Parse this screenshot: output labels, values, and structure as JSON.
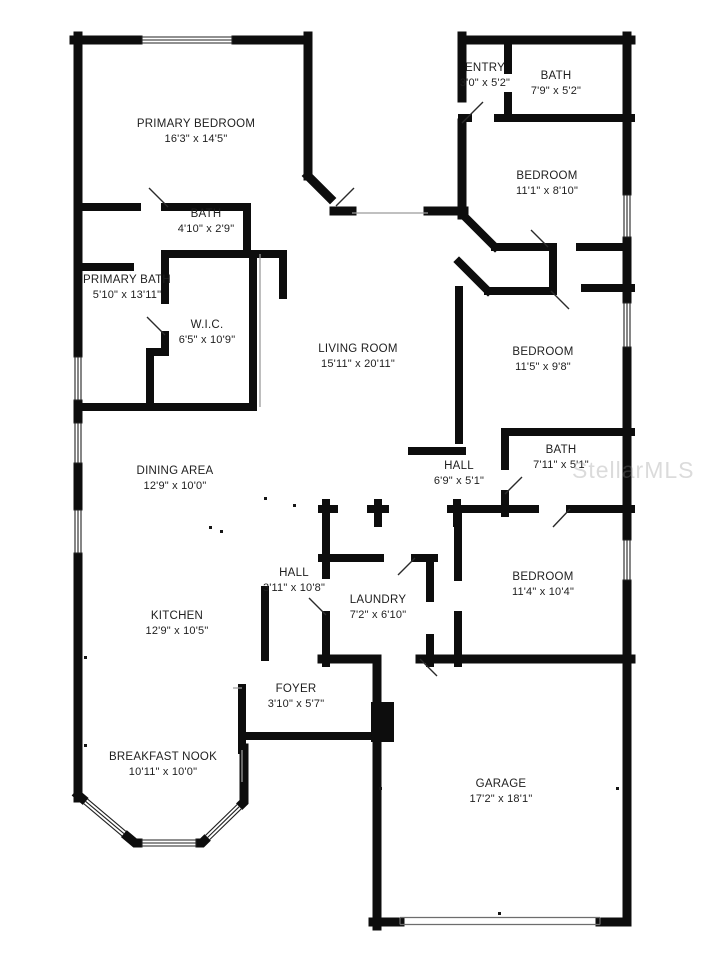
{
  "plan": {
    "type": "residential-floor-plan",
    "watermark": {
      "text": "StellarMLS",
      "color_hex": "#8a8a8a"
    },
    "colors": {
      "walls": "#0d0d0d",
      "labels": "#1e1e1e",
      "background": "#ffffff"
    },
    "rooms": [
      {
        "name": "PRIMARY BEDROOM",
        "dims": "16'3\" x 14'5\"",
        "cx": 196,
        "cy": 132
      },
      {
        "name": "BATH",
        "dims": "4'10\" x 2'9\"",
        "cx": 206,
        "cy": 222
      },
      {
        "name": "PRIMARY BATH",
        "dims": "5'10\" x 13'11\"",
        "cx": 127,
        "cy": 288
      },
      {
        "name": "W.I.C.",
        "dims": "6'5\" x 10'9\"",
        "cx": 207,
        "cy": 333
      },
      {
        "name": "LIVING ROOM",
        "dims": "15'11\" x 20'11\"",
        "cx": 358,
        "cy": 357
      },
      {
        "name": "ENTRY",
        "dims": "3'0\" x 5'2\"",
        "cx": 485,
        "cy": 76
      },
      {
        "name": "BATH",
        "dims": "7'9\" x 5'2\"",
        "cx": 556,
        "cy": 84
      },
      {
        "name": "BEDROOM",
        "dims": "11'1\" x 8'10\"",
        "cx": 547,
        "cy": 184
      },
      {
        "name": "BEDROOM",
        "dims": "11'5\" x 9'8\"",
        "cx": 543,
        "cy": 360
      },
      {
        "name": "BATH",
        "dims": "7'11\" x 5'1\"",
        "cx": 561,
        "cy": 458
      },
      {
        "name": "HALL",
        "dims": "6'9\" x 5'1\"",
        "cx": 459,
        "cy": 474
      },
      {
        "name": "DINING AREA",
        "dims": "12'9\" x 10'0\"",
        "cx": 175,
        "cy": 479
      },
      {
        "name": "HALL",
        "dims": "3'11\" x 10'8\"",
        "cx": 294,
        "cy": 581
      },
      {
        "name": "KITCHEN",
        "dims": "12'9\" x 10'5\"",
        "cx": 177,
        "cy": 624
      },
      {
        "name": "LAUNDRY",
        "dims": "7'2\" x 6'10\"",
        "cx": 378,
        "cy": 608
      },
      {
        "name": "BEDROOM",
        "dims": "11'4\" x 10'4\"",
        "cx": 543,
        "cy": 585
      },
      {
        "name": "FOYER",
        "dims": "3'10\" x 5'7\"",
        "cx": 296,
        "cy": 697
      },
      {
        "name": "BREAKFAST NOOK",
        "dims": "10'11\" x 10'0\"",
        "cx": 163,
        "cy": 765
      },
      {
        "name": "GARAGE",
        "dims": "17'2\" x 18'1\"",
        "cx": 501,
        "cy": 792
      }
    ]
  }
}
